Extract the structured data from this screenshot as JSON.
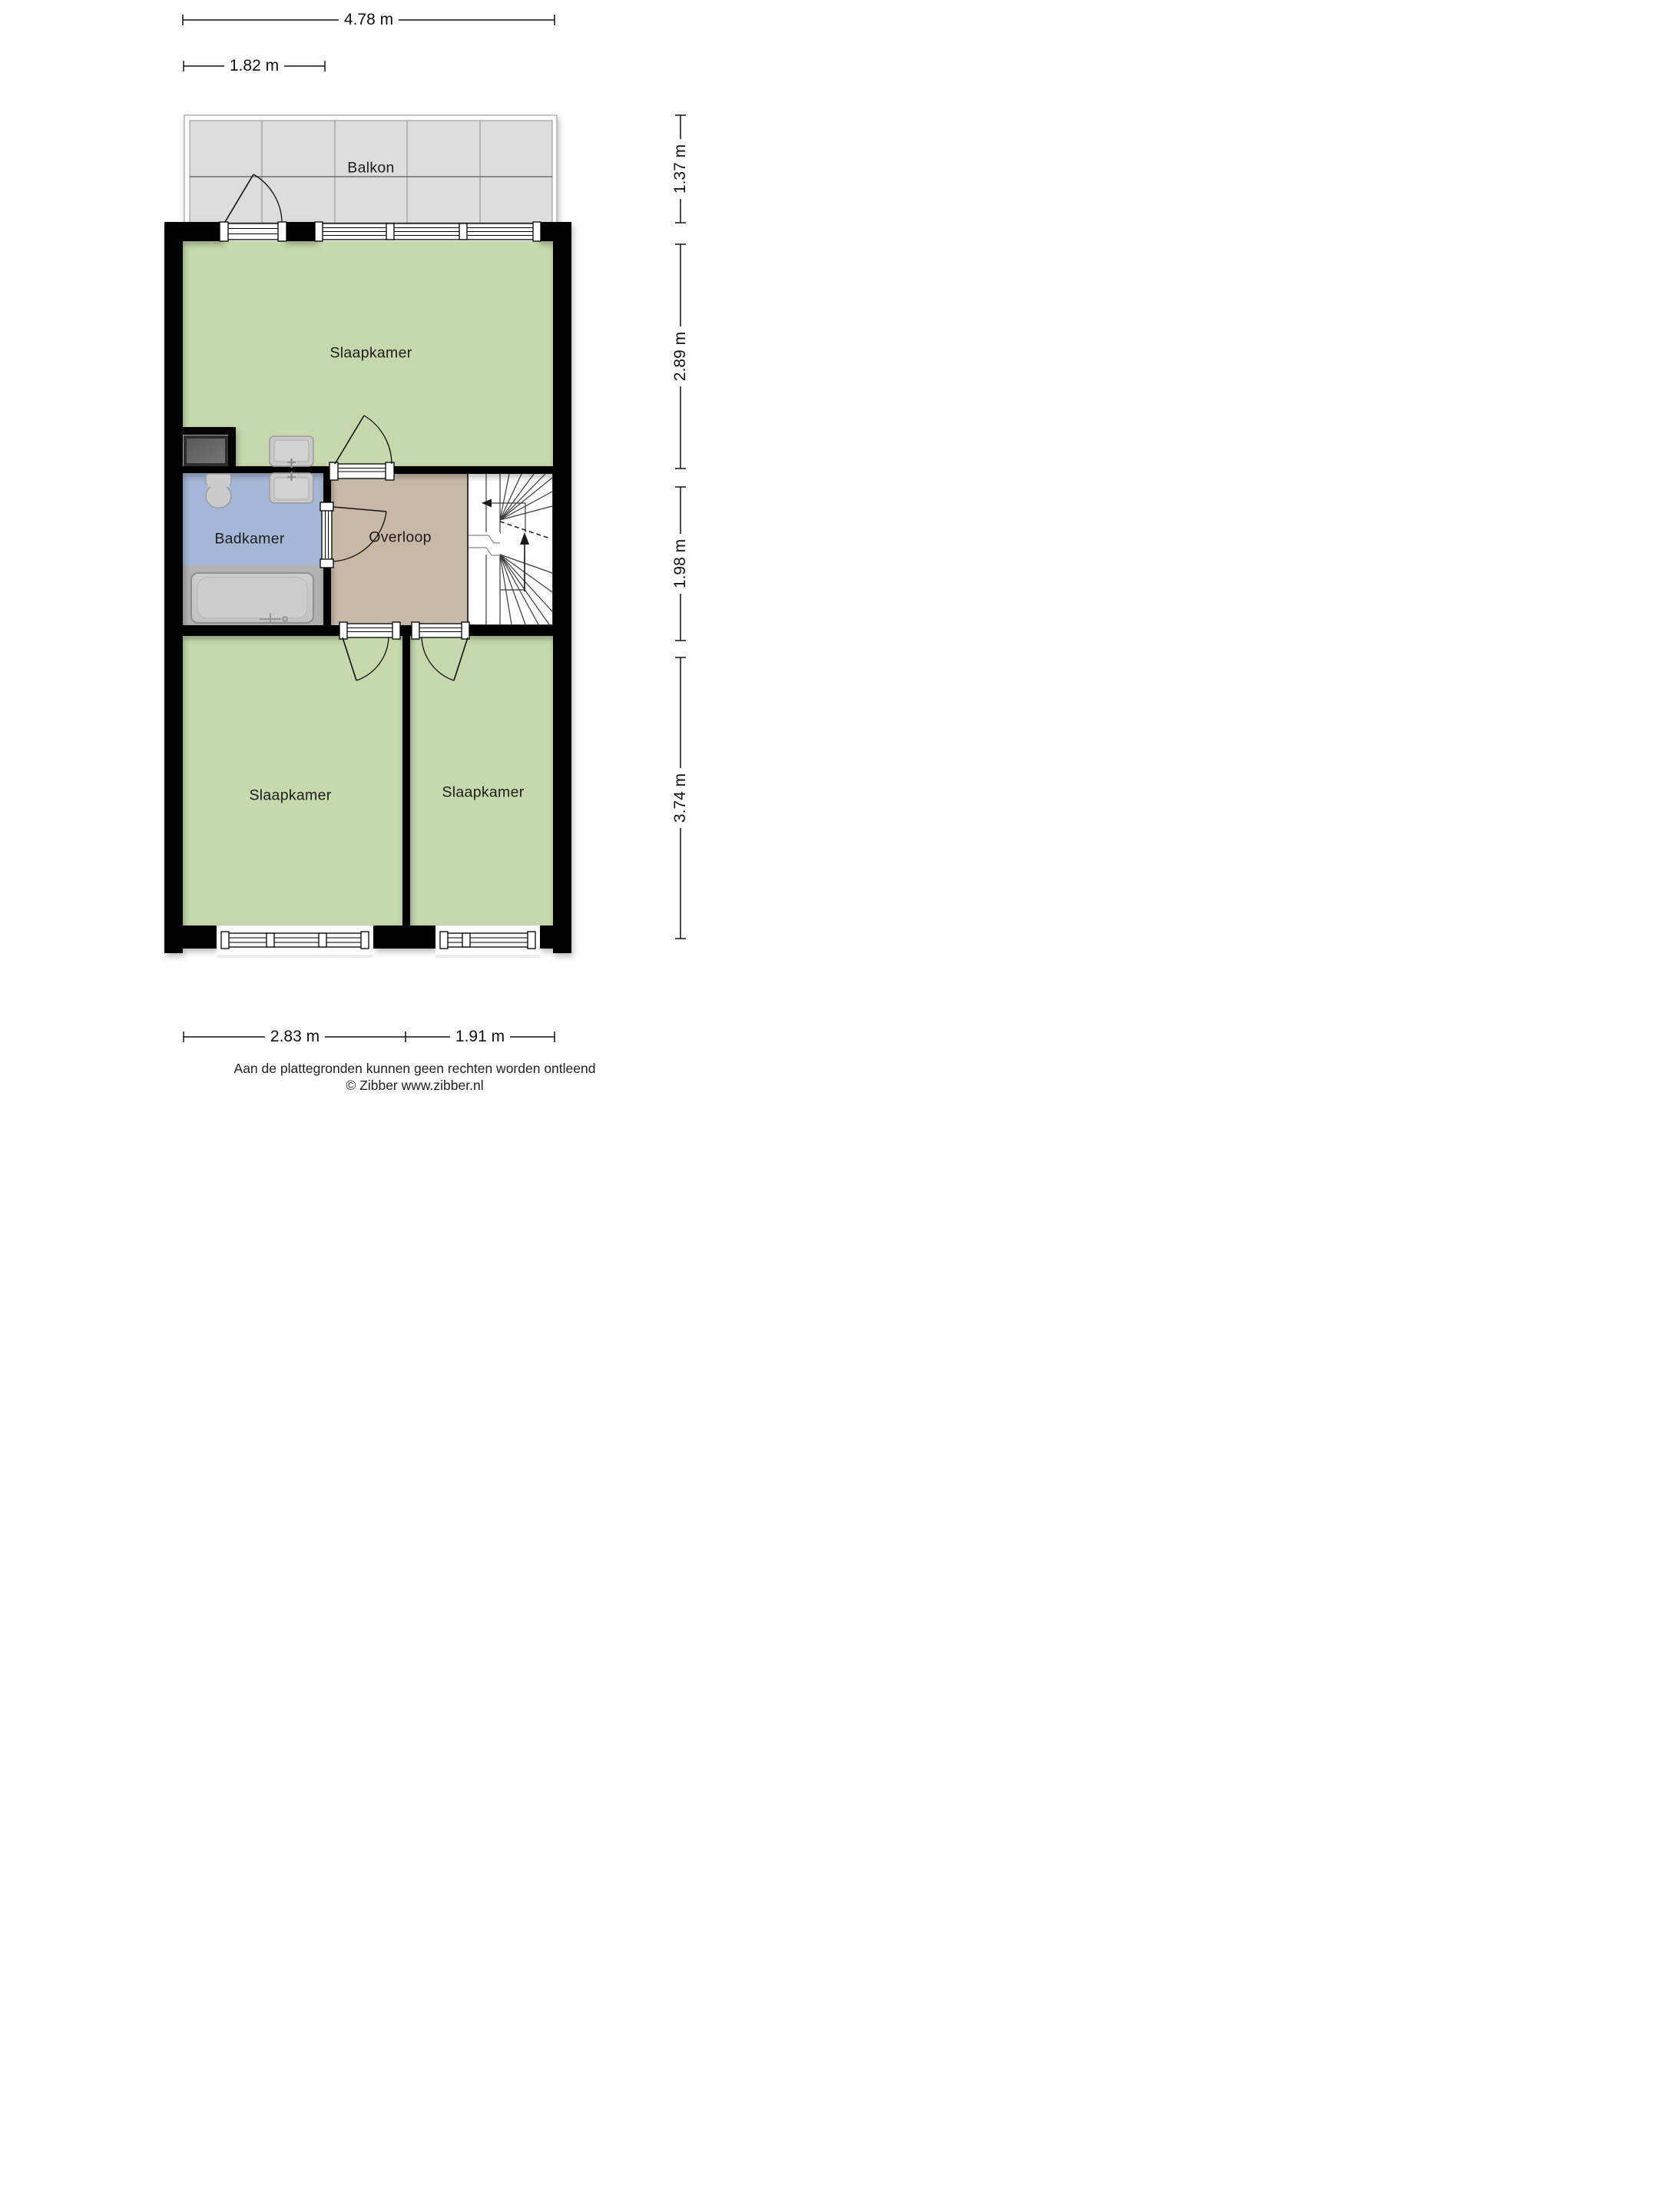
{
  "floorplan": {
    "rooms": [
      {
        "id": "balkon",
        "label": "Balkon"
      },
      {
        "id": "slaapkamer-top",
        "label": "Slaapkamer"
      },
      {
        "id": "badkamer",
        "label": "Badkamer"
      },
      {
        "id": "overloop",
        "label": "Overloop"
      },
      {
        "id": "slaapkamer-left",
        "label": "Slaapkamer"
      },
      {
        "id": "slaapkamer-right",
        "label": "Slaapkamer"
      }
    ],
    "dimensions": {
      "top": [
        {
          "value": "4.78 m"
        },
        {
          "value": "1.82 m"
        }
      ],
      "right": [
        {
          "value": "1.37 m"
        },
        {
          "value": "2.89 m"
        },
        {
          "value": "1.98 m"
        },
        {
          "value": "3.74 m"
        }
      ],
      "bottom": [
        {
          "value": "2.83 m"
        },
        {
          "value": "1.91 m"
        }
      ]
    },
    "icons": [
      "stairs-icon",
      "toilet-icon",
      "sink-icon",
      "bathtub-icon",
      "door-swing-icon",
      "window-icon",
      "direction-arrow-icon",
      "cupboard-icon"
    ],
    "colors": {
      "wall": "#000000",
      "room_green": "#c5d9ac",
      "bathroom_blue": "#a4b7d6",
      "landing_tan": "#c8b9a7",
      "wet_zone_gray": "#b2b2b2",
      "balcony_gray": "#dcdddc",
      "fixture_gray": "#c9c9c9"
    }
  },
  "footer": {
    "disclaimer": "Aan de plattegronden kunnen geen rechten worden ontleend",
    "credit": "© Zibber www.zibber.nl"
  }
}
